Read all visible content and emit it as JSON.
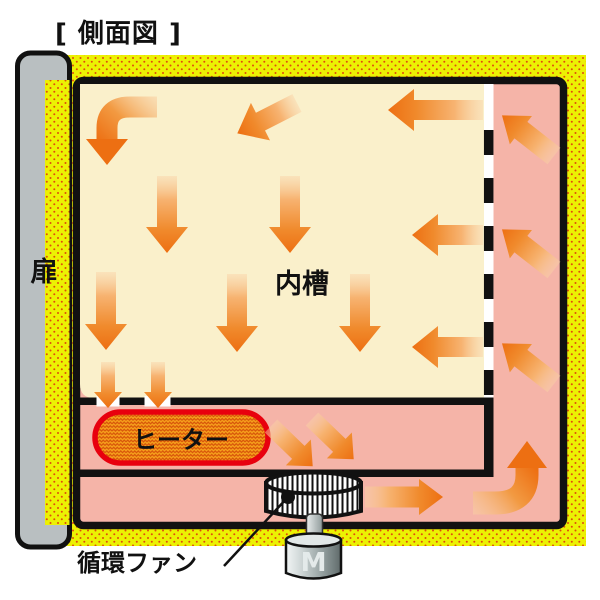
{
  "title": "[ 側面図 ]",
  "labels": {
    "door": "扉",
    "inner_chamber": "内槽",
    "heater": "ヒーター",
    "circulation_fan": "循環ファン",
    "motor": "M"
  },
  "colors": {
    "insulation_yellow": "#ECF103",
    "insulation_dot": "#E04B0C",
    "chamber_cream": "#FAF0CB",
    "duct_pink": "#F5B4A8",
    "door_gray": "#B9BFC1",
    "outline_black": "#111111",
    "arrow_head_orange": "#ED6F12",
    "arrow_tail_orange": "#F9D2A6",
    "heater_fill": "#F6A11C",
    "heater_zigzag": "#D8560A",
    "heater_border": "#E8000E"
  },
  "airflow_arrows": [
    {
      "area": "inner-chamber",
      "type": "large",
      "x": 167,
      "y": 176,
      "angle": 90,
      "len": 77
    },
    {
      "area": "inner-chamber",
      "type": "large",
      "x": 290,
      "y": 176,
      "angle": 90,
      "len": 77
    },
    {
      "area": "inner-chamber",
      "type": "large",
      "x": 106,
      "y": 272,
      "angle": 90,
      "len": 78
    },
    {
      "area": "inner-chamber",
      "type": "large",
      "x": 237,
      "y": 274,
      "angle": 90,
      "len": 78
    },
    {
      "area": "inner-chamber",
      "type": "large",
      "x": 360,
      "y": 274,
      "angle": 90,
      "len": 78
    },
    {
      "area": "inner-chamber",
      "type": "large",
      "x": 297,
      "y": 103,
      "angle": 153,
      "len": 67
    },
    {
      "area": "inner-chamber",
      "type": "large",
      "x": 483,
      "y": 110,
      "angle": 180,
      "len": 95
    },
    {
      "area": "inner-chamber",
      "type": "large",
      "x": 483,
      "y": 235,
      "angle": 180,
      "len": 71
    },
    {
      "area": "inner-chamber",
      "type": "large",
      "x": 483,
      "y": 347,
      "angle": 180,
      "len": 71
    },
    {
      "area": "chamber-outlet",
      "type": "small",
      "x": 108,
      "y": 362,
      "angle": 90,
      "len": 46
    },
    {
      "area": "chamber-outlet",
      "type": "small",
      "x": 158,
      "y": 362,
      "angle": 90,
      "len": 46
    },
    {
      "area": "heater-band",
      "type": "band",
      "x": 271,
      "y": 426,
      "angle": 44,
      "len": 58
    },
    {
      "area": "heater-band",
      "type": "band",
      "x": 312,
      "y": 419,
      "angle": 44,
      "len": 58
    },
    {
      "area": "bottom-duct",
      "type": "duct",
      "x": 365,
      "y": 497,
      "angle": 0,
      "len": 78
    },
    {
      "area": "right-duct",
      "type": "duct",
      "x": 554,
      "y": 156,
      "angle": -142,
      "len": 66
    },
    {
      "area": "right-duct",
      "type": "duct",
      "x": 554,
      "y": 270,
      "angle": -142,
      "len": 66
    },
    {
      "area": "right-duct",
      "type": "duct",
      "x": 554,
      "y": 384,
      "angle": -142,
      "len": 66
    }
  ]
}
